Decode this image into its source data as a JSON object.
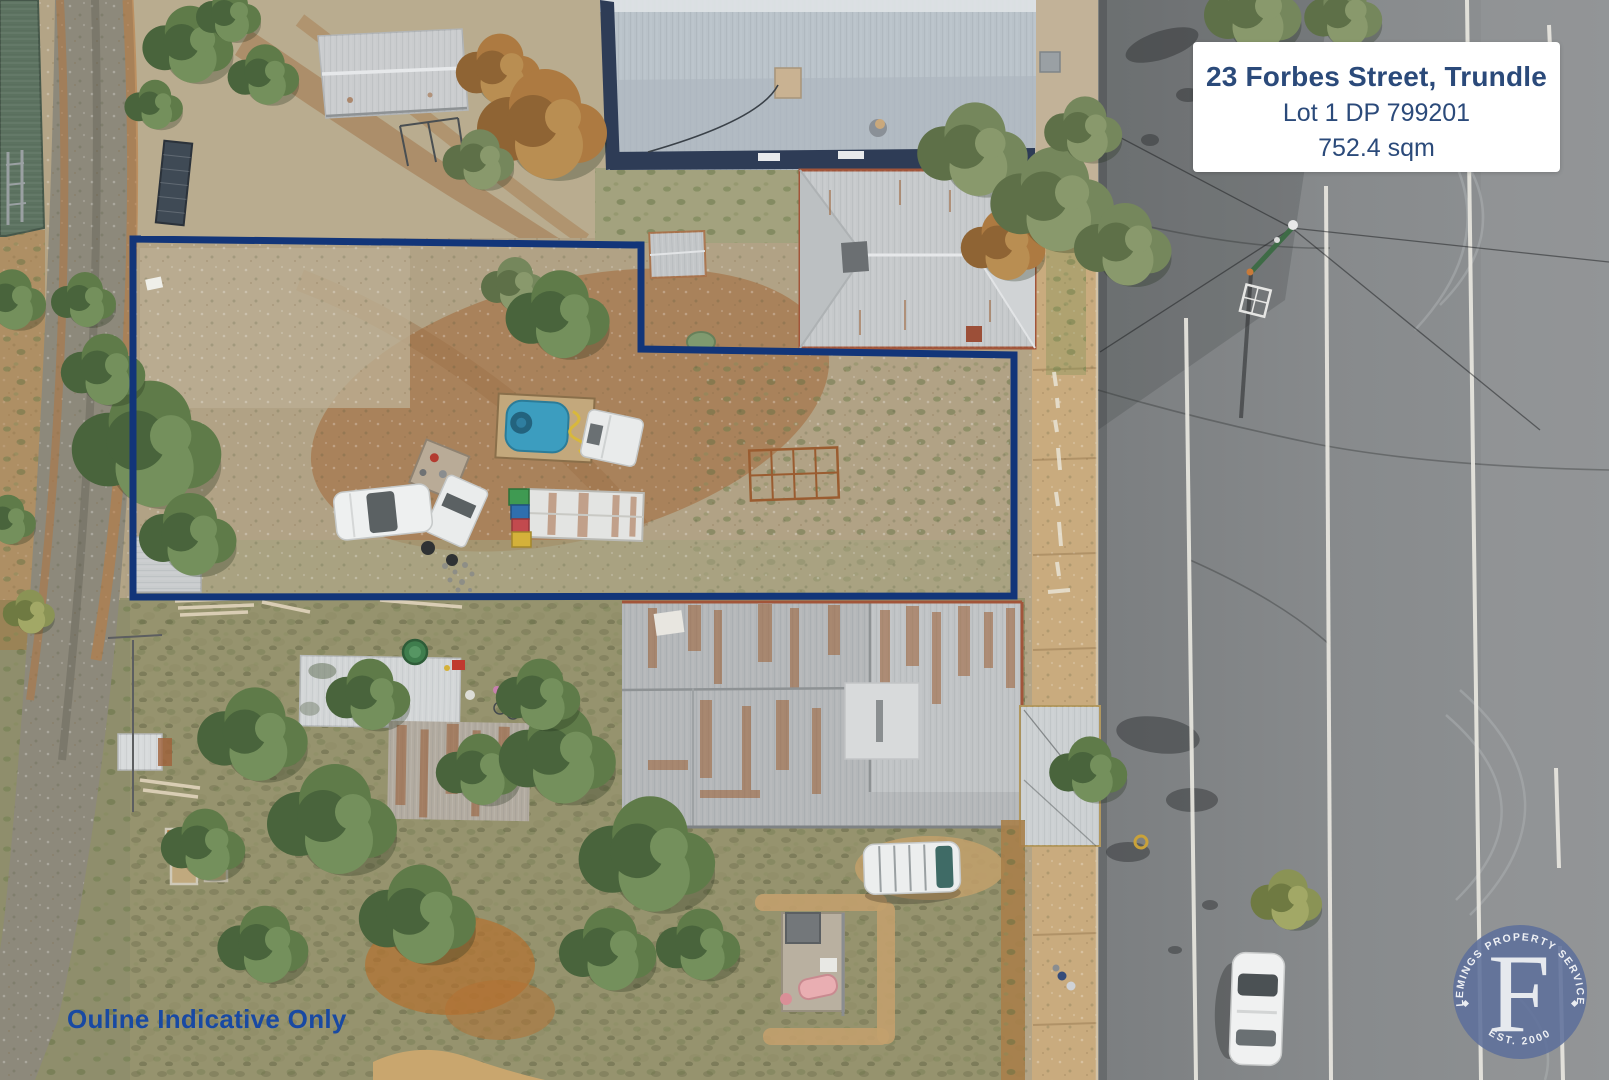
{
  "overlay": {
    "info_card": {
      "line1": "23 Forbes Street, Trundle",
      "line2": "Lot 1 DP 799201",
      "line3": "752.4 sqm"
    },
    "disclaimer": "Ouline Indicative Only",
    "logo": {
      "arc_top": "FLEMINGS PROPERTY SERVICES",
      "arc_bottom": "EST. 2000",
      "monogram": "F"
    }
  },
  "colors": {
    "boundary_outline": "#123579",
    "card_text": "#2b4a7a",
    "disclaimer_text": "#1849a3",
    "logo_circle": "#5d6f9b",
    "logo_text": "#e9ecf1"
  }
}
